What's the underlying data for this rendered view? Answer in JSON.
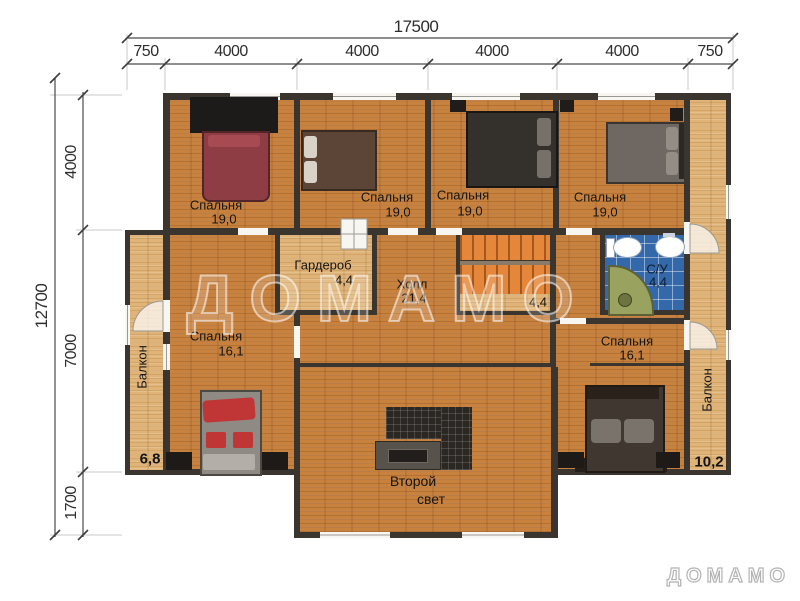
{
  "dims": {
    "total_w": "17500",
    "w1": "750",
    "w2": "4000",
    "w3": "4000",
    "w4": "4000",
    "w5": "4000",
    "w6": "750",
    "total_h": "12700",
    "h1": "4000",
    "h2": "7000",
    "h3": "1700"
  },
  "rooms": {
    "b1": {
      "name": "Спальня",
      "area": "19,0"
    },
    "b2": {
      "name": "Спальня",
      "area": "19,0"
    },
    "b3": {
      "name": "Спальня",
      "area": "19,0"
    },
    "b4": {
      "name": "Спальня",
      "area": "19,0"
    },
    "wardrobe": {
      "name": "Гардероб",
      "area": "4,4"
    },
    "hall": {
      "name": "Холл",
      "area": "21,4"
    },
    "stairs": {
      "area": "4,4"
    },
    "bath": {
      "name": "С/У",
      "area": "4,4"
    },
    "b5": {
      "name": "Спальня",
      "area": "16,1"
    },
    "b6": {
      "name": "Спальня",
      "area": "16,1"
    },
    "balcony_left": {
      "name": "Балкон",
      "area": "6,8"
    },
    "balcony_right": {
      "name": "Балкон",
      "area": "10,2"
    },
    "second_light": {
      "line1": "Второй",
      "line2": "свет"
    }
  },
  "watermark": {
    "center": "ДОМАМО",
    "logo": "ДОМАМО"
  },
  "colors": {
    "floor": "#c8823e",
    "floor_light": "#e0b478",
    "wall": "#3a352f",
    "tile": "#3368aa",
    "stairs": "#e5873a",
    "bed_red": "#8e3d45",
    "bed_brown": "#5c4536",
    "bed_dark": "#34302b",
    "bed_gray": "#6f6761",
    "accent_red": "#c03535"
  }
}
